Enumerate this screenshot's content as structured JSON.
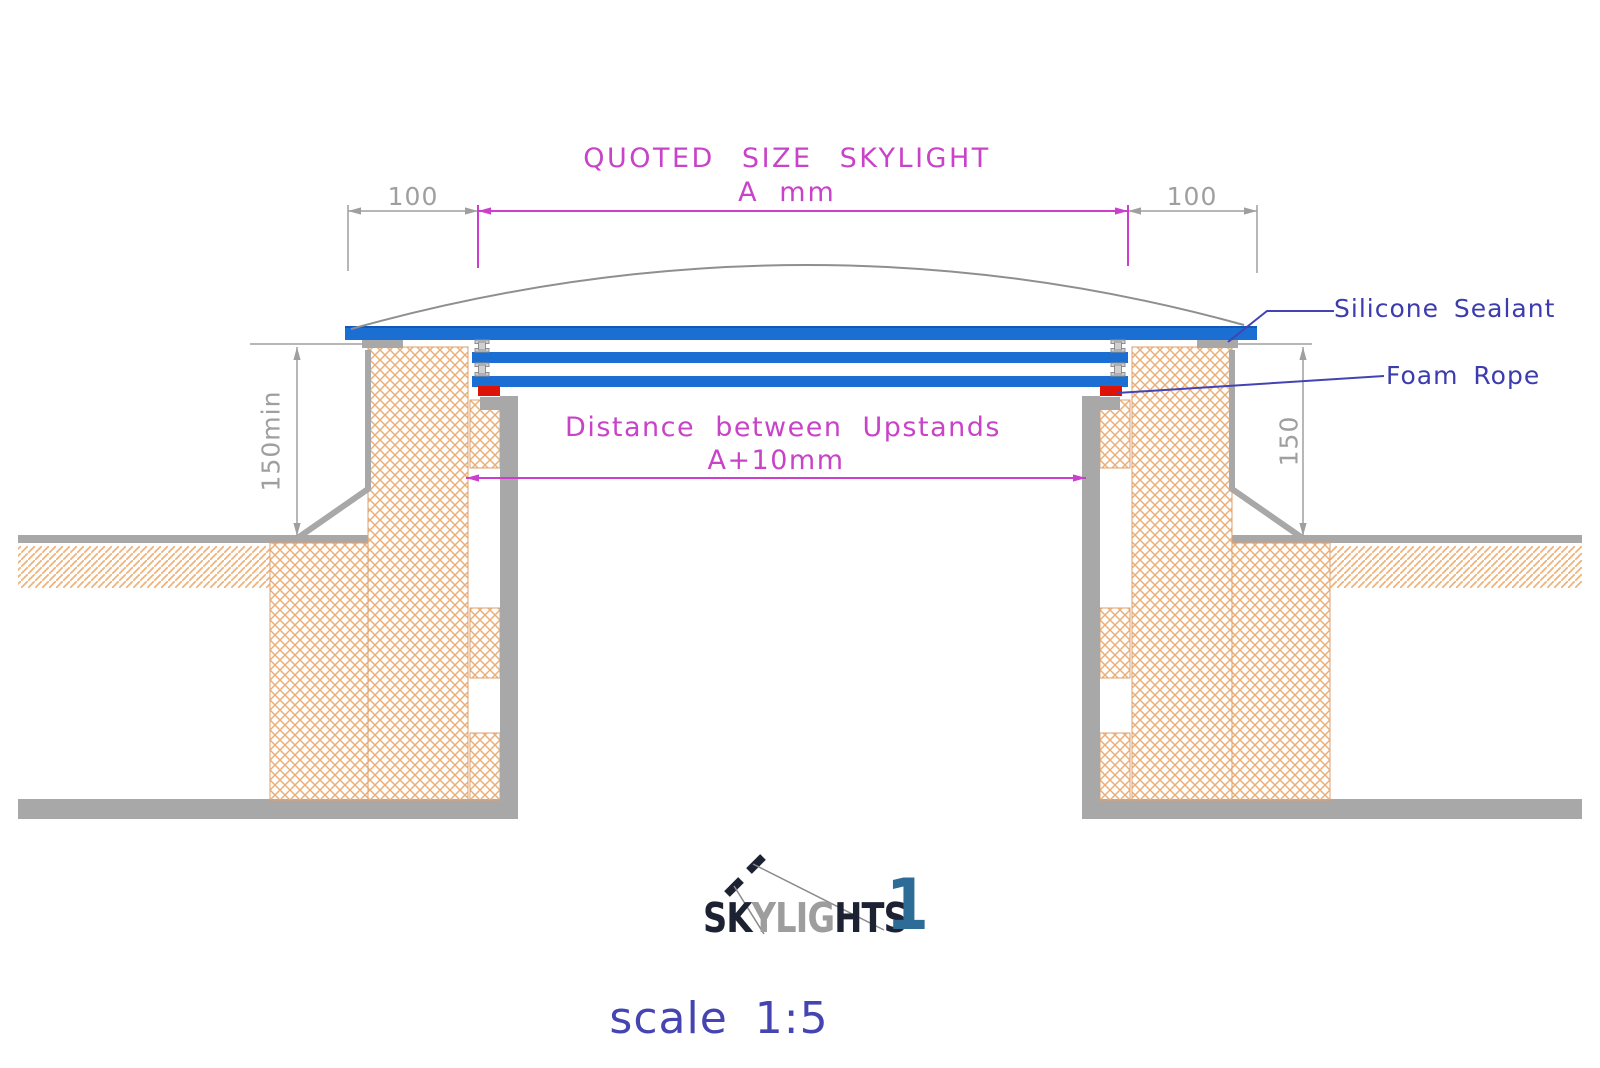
{
  "title": {
    "line1": "QUOTED SIZE SKYLIGHT",
    "line2": "A mm"
  },
  "dimensions": {
    "left_overhang": "100",
    "right_overhang": "100",
    "left_upstand_height": "150min",
    "right_upstand_height": "150",
    "span_label_line1": "Distance between Upstands",
    "span_label_line2": "A+10mm"
  },
  "callouts": {
    "silicone_sealant": "Silicone Sealant",
    "foam_rope": "Foam Rope"
  },
  "logo": {
    "text_dark_1": "SK",
    "text_gray": "YLIG",
    "text_dark_2": "HTS",
    "numeral": "1"
  },
  "footer": {
    "scale_note": "scale 1:5"
  },
  "colors": {
    "dimension_magenta": "#cc3ecc",
    "annotation_blue": "#4040b0",
    "glass_blue": "#1c6fd2",
    "hatch_orange": "#eaaf79",
    "structure_gray": "#a8a8a8",
    "dimension_gray": "#9f9f9f",
    "foam_rope_red": "#dc1408",
    "logo_blue": "#2e6c98",
    "logo_dark": "#1d2233",
    "logo_gray": "#9d9d9d",
    "scale_text_blue": "#4545b2"
  }
}
